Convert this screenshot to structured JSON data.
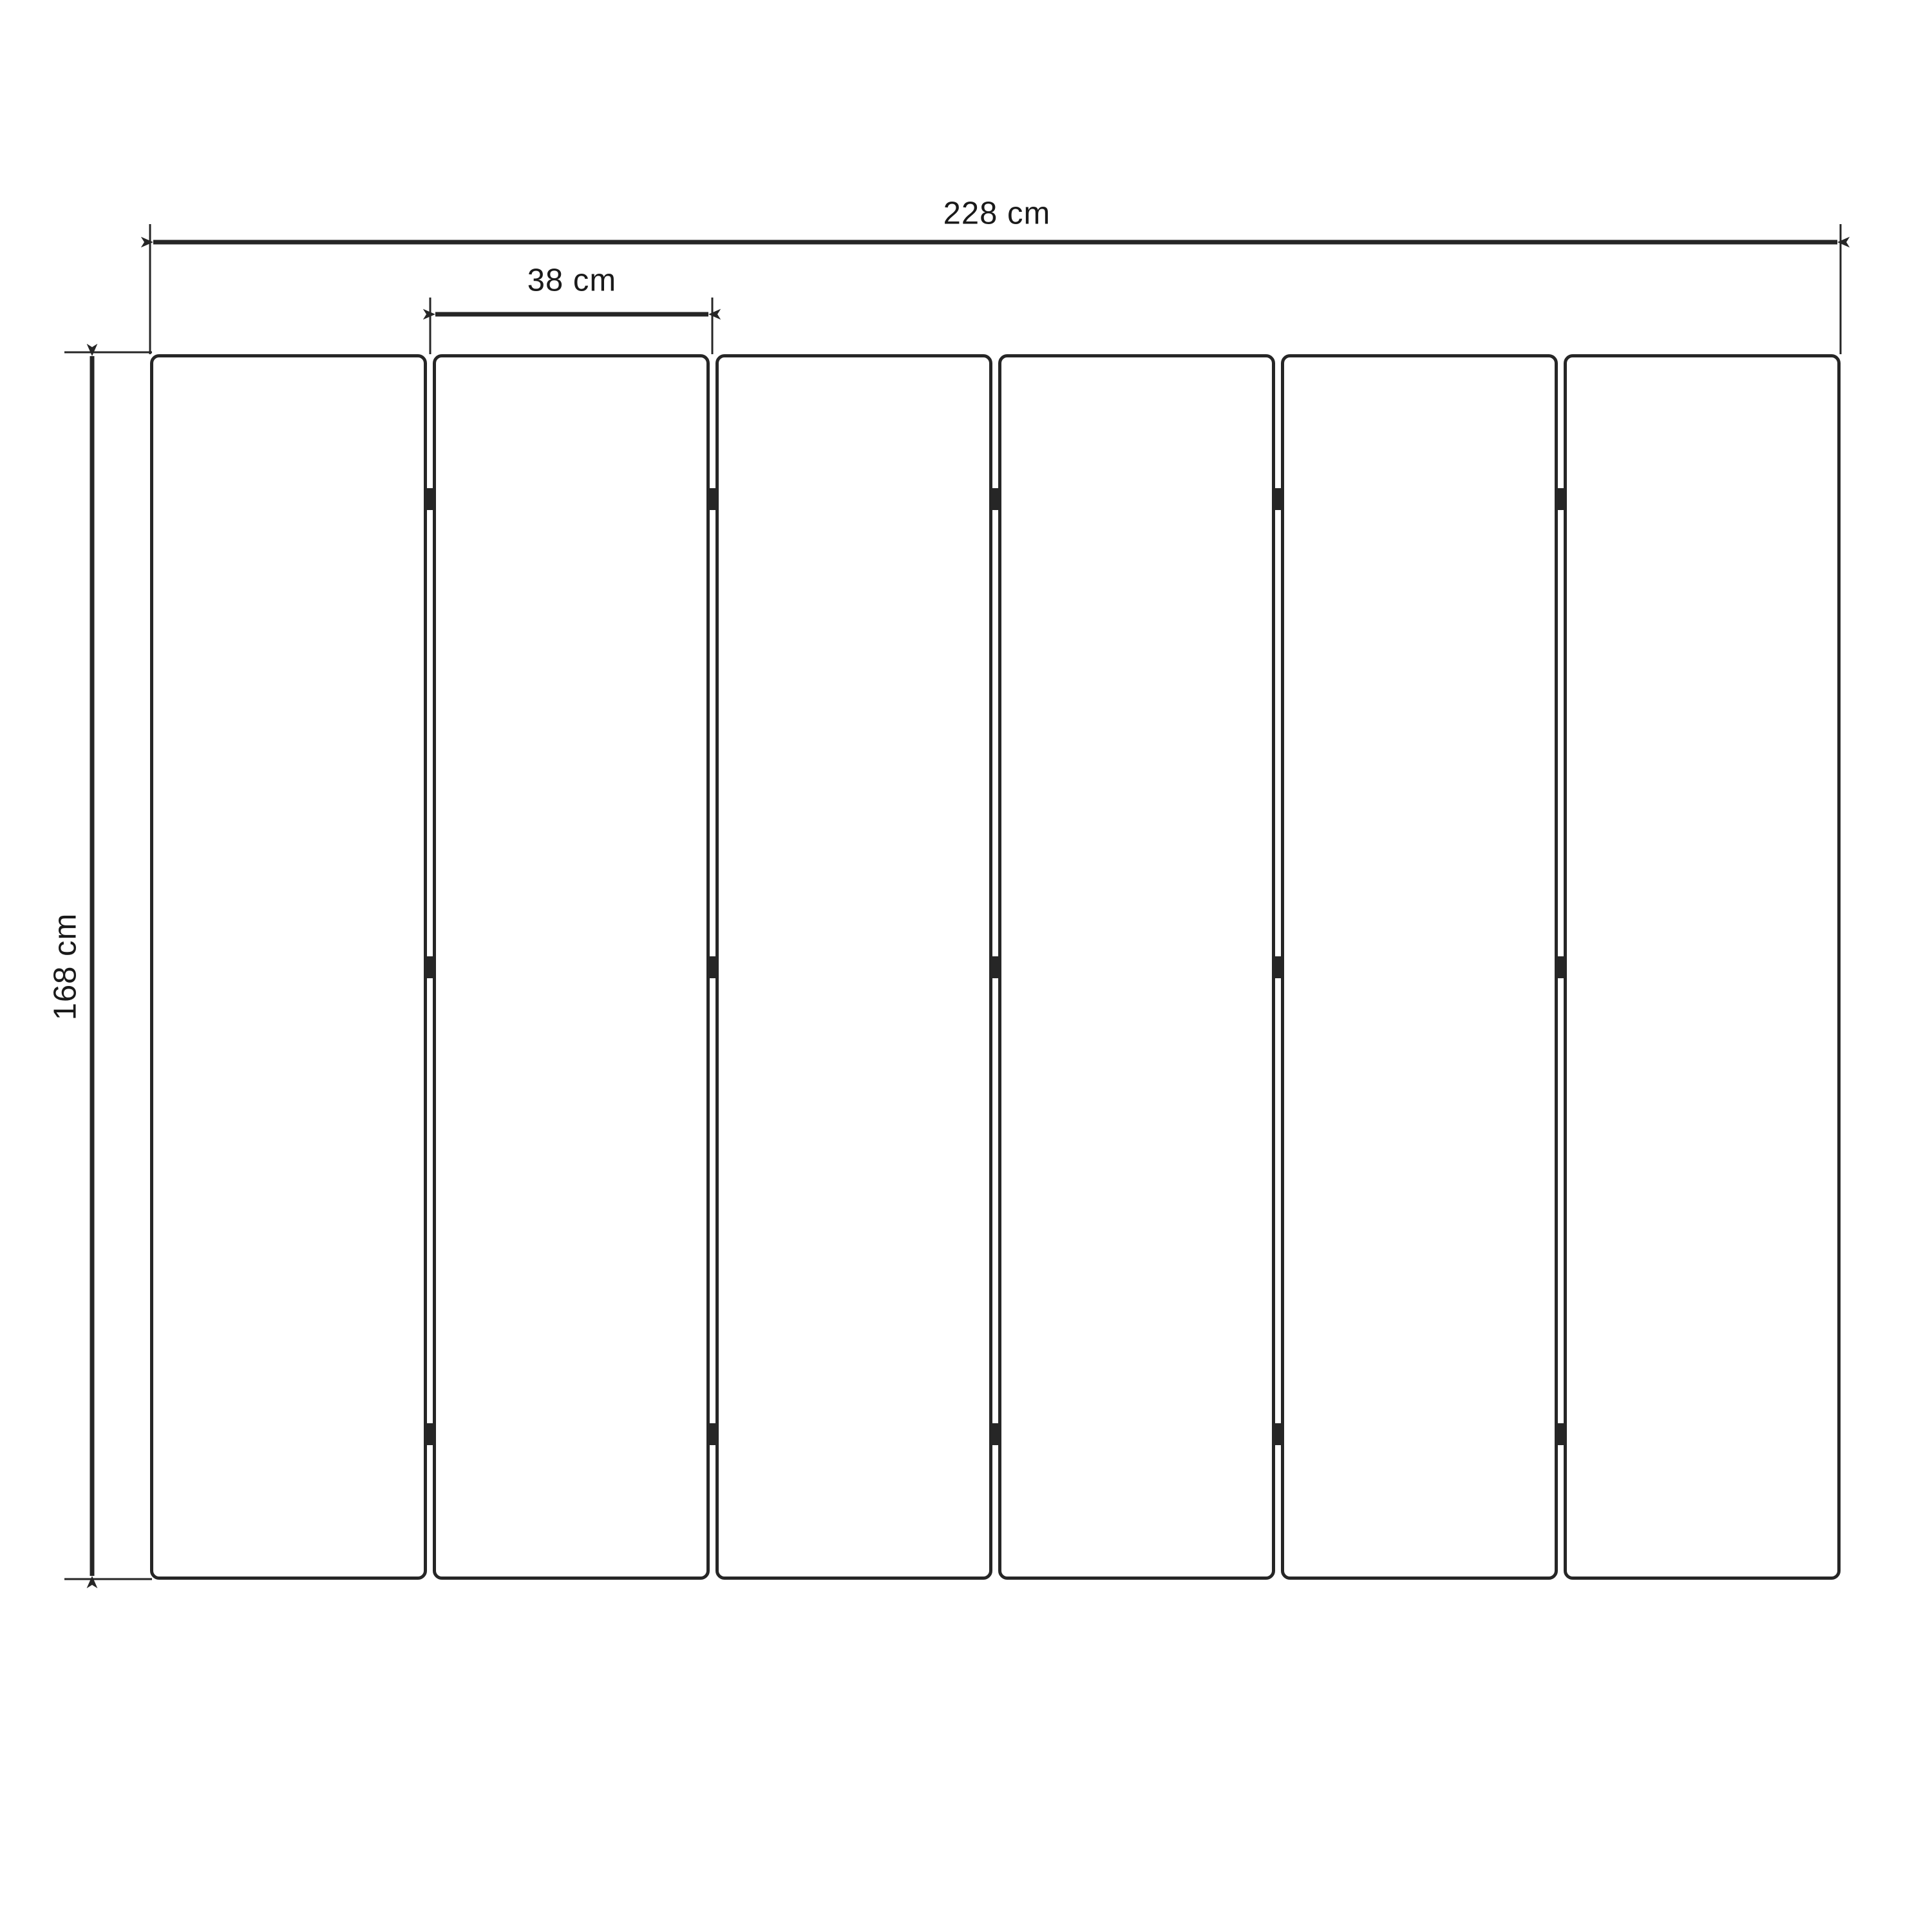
{
  "drawing": {
    "kind": "folding-screen-dimension-drawing",
    "panel_count": 6,
    "gap_count": 5,
    "hinge_rows": 3,
    "hinge_row_positions_pct": [
      11.8,
      50,
      88.1
    ],
    "labels": {
      "total_width": "228 cm",
      "panel_width": "38 cm",
      "height": "168 cm"
    },
    "colors": {
      "stroke": "#262626",
      "text": "#1a1a1a",
      "background": "#ffffff",
      "panel_fill": "#ffffff"
    }
  }
}
